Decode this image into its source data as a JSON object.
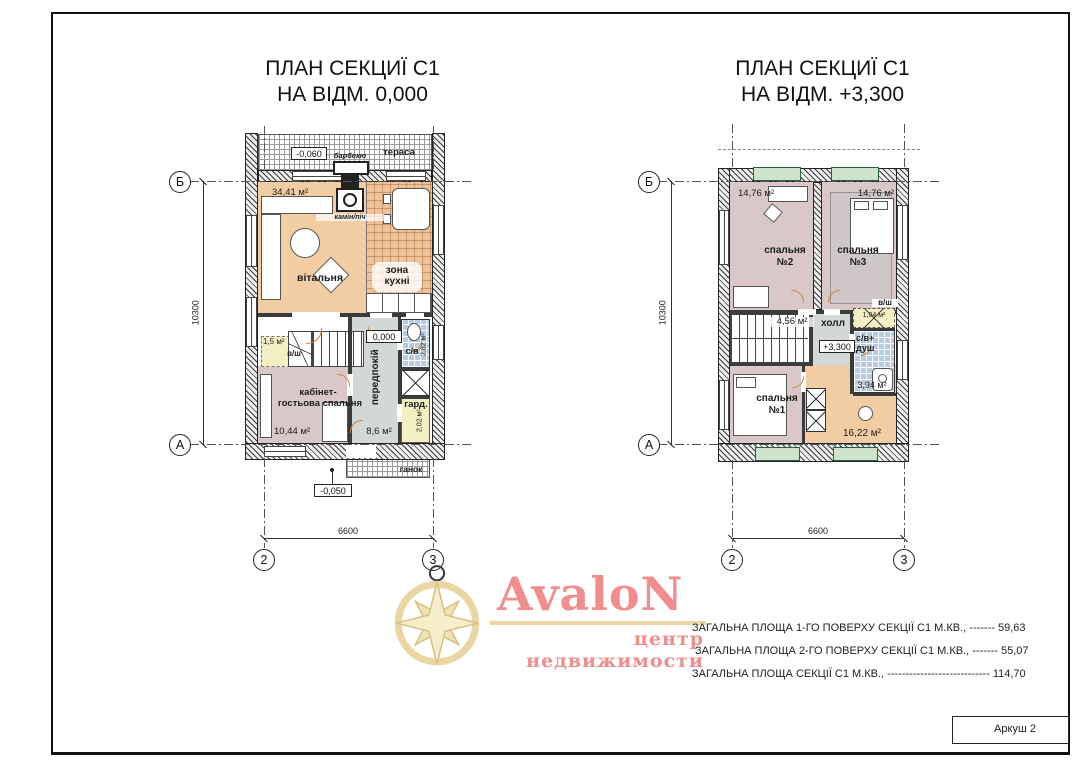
{
  "sheet": {
    "label": "Аркуш 2"
  },
  "logo": {
    "name": "AvaloN",
    "subtitle": "центр недвижимости"
  },
  "summary": {
    "line1_label": "ЗАГАЛЬНА ПЛОЩА 1-ГО ПОВЕРХУ СЕКЦІЇ С1  М.КВ., -------",
    "line1_value": "59,63",
    "line2_label": "ЗАГАЛЬНА ПЛОЩА 2-ГО ПОВЕРХУ СЕКЦІЇ С1  М.КВ., -------",
    "line2_value": "55,07",
    "line3_label": "ЗАГАЛЬНА ПЛОЩА СЕКЦІЇ С1  М.КВ., ----------------------------",
    "line3_value": "114,70"
  },
  "plan1": {
    "title1": "ПЛАН СЕКЦИЇ С1",
    "title2": "НА ВІДМ. 0,000",
    "axes": {
      "row_top": "Б",
      "row_bottom": "А",
      "col_left": "2",
      "col_right": "3"
    },
    "dims": {
      "height": "10300",
      "width": "6600"
    },
    "levels": {
      "terrace": "-0,060",
      "floor": "0,000",
      "porch": "-0,050"
    },
    "rooms": {
      "terrace": "тераса",
      "bbq": "барбекю",
      "fireplace": "камін/піч",
      "living": "вітальня",
      "living_area": "34,41 м²",
      "kitchen_line1": "зона",
      "kitchen_line2": "кухні",
      "closet_area": "1,5 м²",
      "closet": "в/ш",
      "office_line1": "кабінет-",
      "office_line2": "гостьова спальня",
      "office_area": "10,44 м²",
      "hallway": "передпокій",
      "hallway_area": "8,6 м²",
      "bathroom": "с/в",
      "bathroom_area": "2,82 м²",
      "wardrobe": "гард.",
      "wardrobe_area": "2,02 м²",
      "porch": "ганок"
    }
  },
  "plan2": {
    "title1": "ПЛАН СЕКЦИЇ С1",
    "title2": "НА ВІДМ. +3,300",
    "axes": {
      "row_top": "Б",
      "row_bottom": "А",
      "col_left": "2",
      "col_right": "3"
    },
    "dims": {
      "height": "10300",
      "width": "6600"
    },
    "levels": {
      "floor": "+3,300"
    },
    "rooms": {
      "bedroom2_line1": "спальня",
      "bedroom2_line2": "№2",
      "bedroom2_area": "14,76 м²",
      "bedroom3_line1": "спальня",
      "bedroom3_line2": "№3",
      "bedroom3_area": "14,76 м²",
      "stairs_area": "4,56 м²",
      "hall": "холл",
      "closet": "в/ш",
      "closet_area": "1,04 м²",
      "bath_line1": "с/в+",
      "bath_line2": "душ",
      "bath_area": "3,94 м²",
      "bedroom1_line1": "спальня",
      "bedroom1_line2": "№1",
      "open_area": "16,22 м²"
    }
  }
}
